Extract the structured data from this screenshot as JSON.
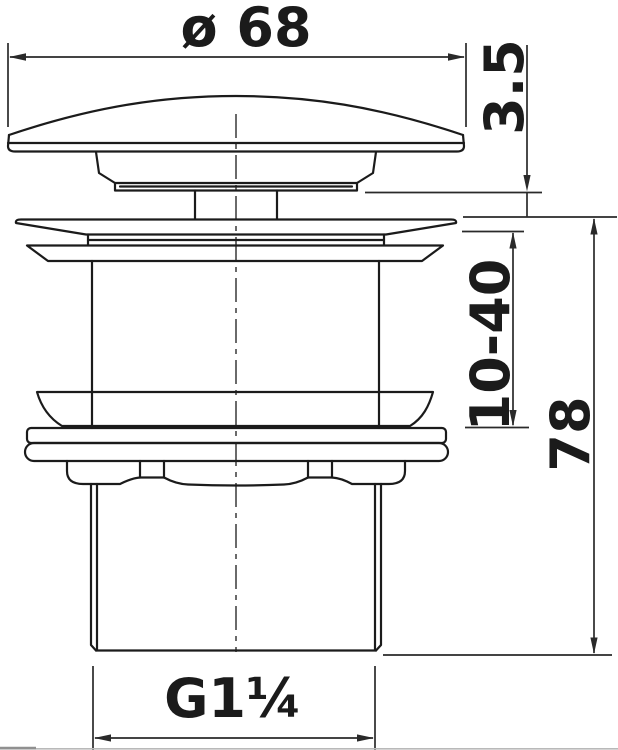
{
  "drawing": {
    "dimensions": {
      "cap_diameter": "ø 68",
      "cap_edge_thickness": "3.5",
      "clamp_range": "10-40",
      "overall_height": "78",
      "thread_size": "G1¼"
    },
    "colors": {
      "line": "#1b1b1b",
      "dim_line": "#2a2a2a",
      "background": "#ffffff",
      "edge_artifact": "#b9b9b9"
    }
  }
}
